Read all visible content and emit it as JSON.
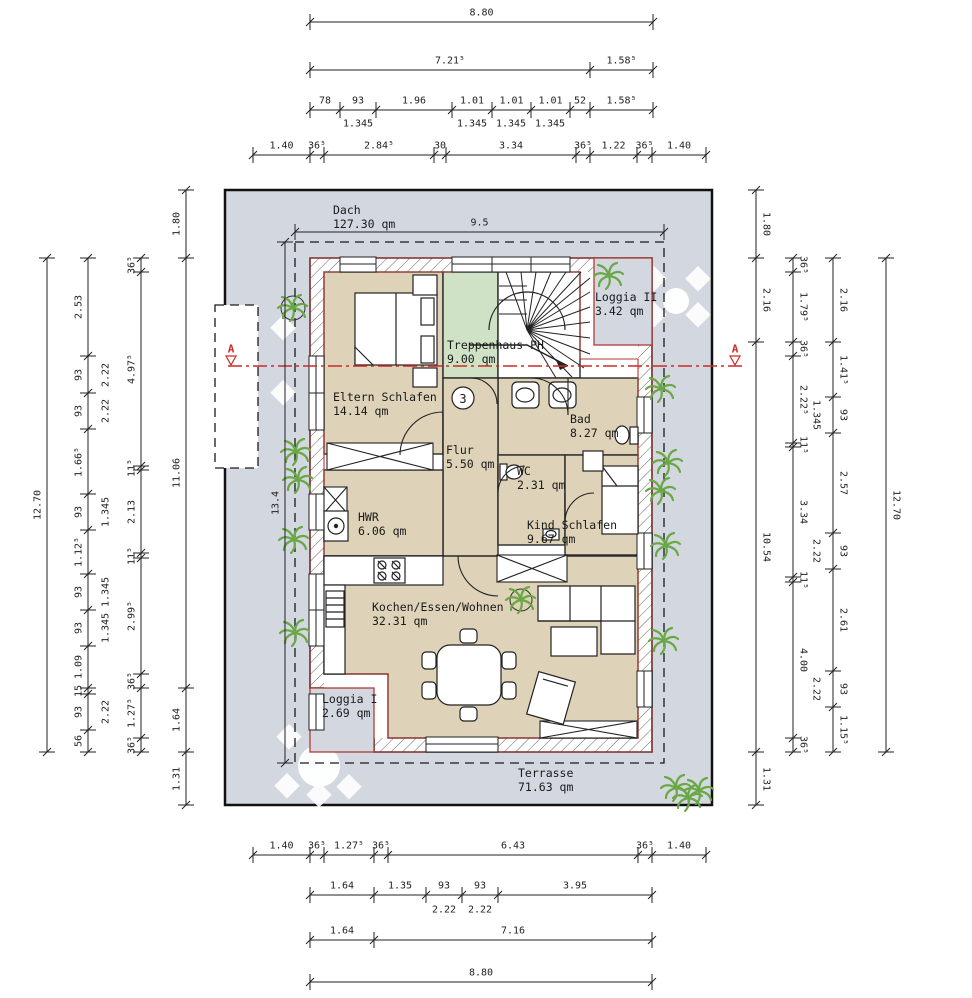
{
  "drawing": {
    "storey_marker": "3",
    "section_marker": "A"
  },
  "colors": {
    "roof_grey": "#d3d7e0",
    "floor_beige": "#ded2b8",
    "stair_green": "#cfe2c5",
    "outline_red": "#b23b35",
    "section_red": "#cc2a27",
    "plant_green": "#69a844",
    "line_black": "#1a1a1a"
  },
  "rooms": [
    {
      "key": "dach",
      "name": "Dach",
      "area": "127.30 qm",
      "x": 333,
      "y": 203
    },
    {
      "key": "loggia-2",
      "name": "Loggia II",
      "area": "3.42 qm",
      "x": 595,
      "y": 290
    },
    {
      "key": "treppenhaus",
      "name": "Treppenhaus PH",
      "area": "9.00 qm",
      "x": 447,
      "y": 338
    },
    {
      "key": "eltern-schlafen",
      "name": "Eltern Schlafen",
      "area": "14.14 qm",
      "x": 333,
      "y": 390
    },
    {
      "key": "bad",
      "name": "Bad",
      "area": "8.27 qm",
      "x": 570,
      "y": 412
    },
    {
      "key": "flur",
      "name": "Flur",
      "area": "5.50 qm",
      "x": 446,
      "y": 443
    },
    {
      "key": "wc",
      "name": "WC",
      "area": "2.31 qm",
      "x": 517,
      "y": 464
    },
    {
      "key": "hwr",
      "name": "HWR",
      "area": "6.06 qm",
      "x": 358,
      "y": 510
    },
    {
      "key": "kind-schlafen",
      "name": "Kind Schlafen",
      "area": "9.67 qm",
      "x": 527,
      "y": 518
    },
    {
      "key": "kochen-essen-wohnen",
      "name": "Kochen/Essen/Wohnen",
      "area": "32.31 qm",
      "x": 372,
      "y": 600
    },
    {
      "key": "loggia-1",
      "name": "Loggia I",
      "area": "2.69 qm",
      "x": 322,
      "y": 692
    },
    {
      "key": "terrasse",
      "name": "Terrasse",
      "area": "71.63 qm",
      "x": 518,
      "y": 766
    }
  ],
  "chains": [
    {
      "o": "h",
      "at": 22,
      "off": -9,
      "rot": 0,
      "ticks": [
        310,
        653
      ],
      "labels": [
        "8.80"
      ]
    },
    {
      "o": "h",
      "at": 70,
      "off": -9,
      "rot": 0,
      "ticks": [
        310,
        590,
        653
      ],
      "labels": [
        "7.21⁵",
        "1.58⁵"
      ]
    },
    {
      "o": "h",
      "at": 110,
      "off": -9,
      "rot": 0,
      "ticks": [
        310,
        340,
        376,
        452,
        492,
        531,
        570,
        590,
        653
      ],
      "labels": [
        "78",
        "93",
        "1.96",
        "1.01",
        "1.01",
        "1.01",
        "52",
        "1.58⁵"
      ]
    },
    {
      "o": "h",
      "at": 155,
      "off": -9,
      "rot": 0,
      "ticks": [
        253,
        310,
        324,
        434,
        446,
        576,
        590,
        637,
        652,
        706
      ],
      "labels": [
        "1.40",
        "36⁵",
        "2.84⁵",
        "30",
        "3.34",
        "36⁵",
        "1.22",
        "36⁵",
        "1.40"
      ]
    },
    {
      "o": "h",
      "at": 232,
      "off": -9,
      "rot": 0,
      "ticks": [
        295,
        664
      ],
      "labels": [
        "9.5"
      ]
    },
    {
      "o": "h",
      "at": 855,
      "off": -9,
      "rot": 0,
      "ticks": [
        253,
        310,
        324,
        374,
        388,
        638,
        652,
        706
      ],
      "labels": [
        "1.40",
        "36⁵",
        "1.27⁵",
        "36⁵",
        "6.43",
        "36⁵",
        "1.40"
      ]
    },
    {
      "o": "h",
      "at": 895,
      "off": -9,
      "rot": 0,
      "ticks": [
        310,
        374,
        426,
        462,
        498,
        652
      ],
      "labels": [
        "1.64",
        "1.35",
        "93",
        "93",
        "3.95"
      ]
    },
    {
      "o": "h",
      "at": 940,
      "off": -9,
      "rot": 0,
      "ticks": [
        310,
        374,
        652
      ],
      "labels": [
        "1.64",
        "7.16"
      ]
    },
    {
      "o": "h",
      "at": 982,
      "off": -9,
      "rot": 0,
      "ticks": [
        310,
        652
      ],
      "labels": [
        "8.80"
      ]
    },
    {
      "o": "v",
      "at": 47,
      "off": -9,
      "rot": -90,
      "ticks": [
        258,
        752
      ],
      "labels": [
        "12.70"
      ]
    },
    {
      "o": "v",
      "at": 88,
      "off": -9,
      "rot": -90,
      "ticks": [
        258,
        356,
        393,
        429,
        494,
        530,
        574,
        610,
        646,
        688,
        694,
        730,
        752
      ],
      "labels": [
        "2.53",
        "93",
        "93",
        "1.66⁵",
        "93",
        "1.12⁵",
        "93",
        "93",
        "1.09",
        "15",
        "93",
        "56"
      ]
    },
    {
      "o": "v",
      "at": 141,
      "off": -9,
      "rot": -90,
      "ticks": [
        258,
        272,
        466,
        470,
        553,
        558,
        674,
        688,
        738,
        752
      ],
      "labels": [
        "36⁵",
        "4.97⁵",
        "11⁵",
        "2.13",
        "11⁵",
        "2.99⁵",
        "36⁵",
        "1.27⁵",
        "36⁵"
      ]
    },
    {
      "o": "v",
      "at": 186,
      "off": -9,
      "rot": -90,
      "ticks": [
        190,
        258,
        688,
        752,
        805
      ],
      "labels": [
        "1.80",
        "11.06",
        "1.64",
        "1.31"
      ]
    },
    {
      "o": "v",
      "at": 285,
      "off": -9,
      "rot": -90,
      "ticks": [
        242,
        763
      ],
      "labels": [
        "13.4"
      ]
    },
    {
      "o": "v",
      "at": 756,
      "off": 10,
      "rot": 90,
      "ticks": [
        190,
        258,
        342,
        752,
        805
      ],
      "labels": [
        "1.80",
        "2.16",
        "10.54",
        "1.31"
      ]
    },
    {
      "o": "v",
      "at": 793,
      "off": 10,
      "rot": 90,
      "ticks": [
        258,
        272,
        342,
        356,
        443,
        447,
        577,
        582,
        738,
        752
      ],
      "labels": [
        "36⁵",
        "1.79⁵",
        "36⁵",
        "2.22⁵",
        "11⁵",
        "3.34",
        "11⁵",
        "4.00",
        "36⁵"
      ]
    },
    {
      "o": "v",
      "at": 833,
      "off": 10,
      "rot": 90,
      "ticks": [
        258,
        342,
        397,
        433,
        533,
        569,
        671,
        707,
        752
      ],
      "labels": [
        "2.16",
        "1.41⁵",
        "93",
        "2.57",
        "93",
        "2.61",
        "93",
        "1.15⁵"
      ]
    },
    {
      "o": "v",
      "at": 886,
      "off": 10,
      "rot": 90,
      "ticks": [
        258,
        752
      ],
      "labels": [
        "12.70"
      ]
    }
  ],
  "free_labels": [
    {
      "t": "1.345",
      "x": 358,
      "y": 124,
      "rot": 0
    },
    {
      "t": "1.345",
      "x": 472,
      "y": 124,
      "rot": 0
    },
    {
      "t": "1.345",
      "x": 511,
      "y": 124,
      "rot": 0
    },
    {
      "t": "1.345",
      "x": 550,
      "y": 124,
      "rot": 0
    },
    {
      "t": "2.22",
      "x": 444,
      "y": 910,
      "rot": 0
    },
    {
      "t": "2.22",
      "x": 480,
      "y": 910,
      "rot": 0
    },
    {
      "t": "2.22",
      "x": 106,
      "y": 375,
      "rot": -90
    },
    {
      "t": "2.22",
      "x": 106,
      "y": 411,
      "rot": -90
    },
    {
      "t": "1.345",
      "x": 106,
      "y": 512,
      "rot": -90
    },
    {
      "t": "1.345",
      "x": 106,
      "y": 592,
      "rot": -90
    },
    {
      "t": "1.345",
      "x": 106,
      "y": 628,
      "rot": -90
    },
    {
      "t": "2.22",
      "x": 106,
      "y": 712,
      "rot": -90
    },
    {
      "t": "1.345",
      "x": 816,
      "y": 415,
      "rot": 90
    },
    {
      "t": "2.22",
      "x": 816,
      "y": 551,
      "rot": 90
    },
    {
      "t": "2.22",
      "x": 816,
      "y": 689,
      "rot": 90
    }
  ]
}
